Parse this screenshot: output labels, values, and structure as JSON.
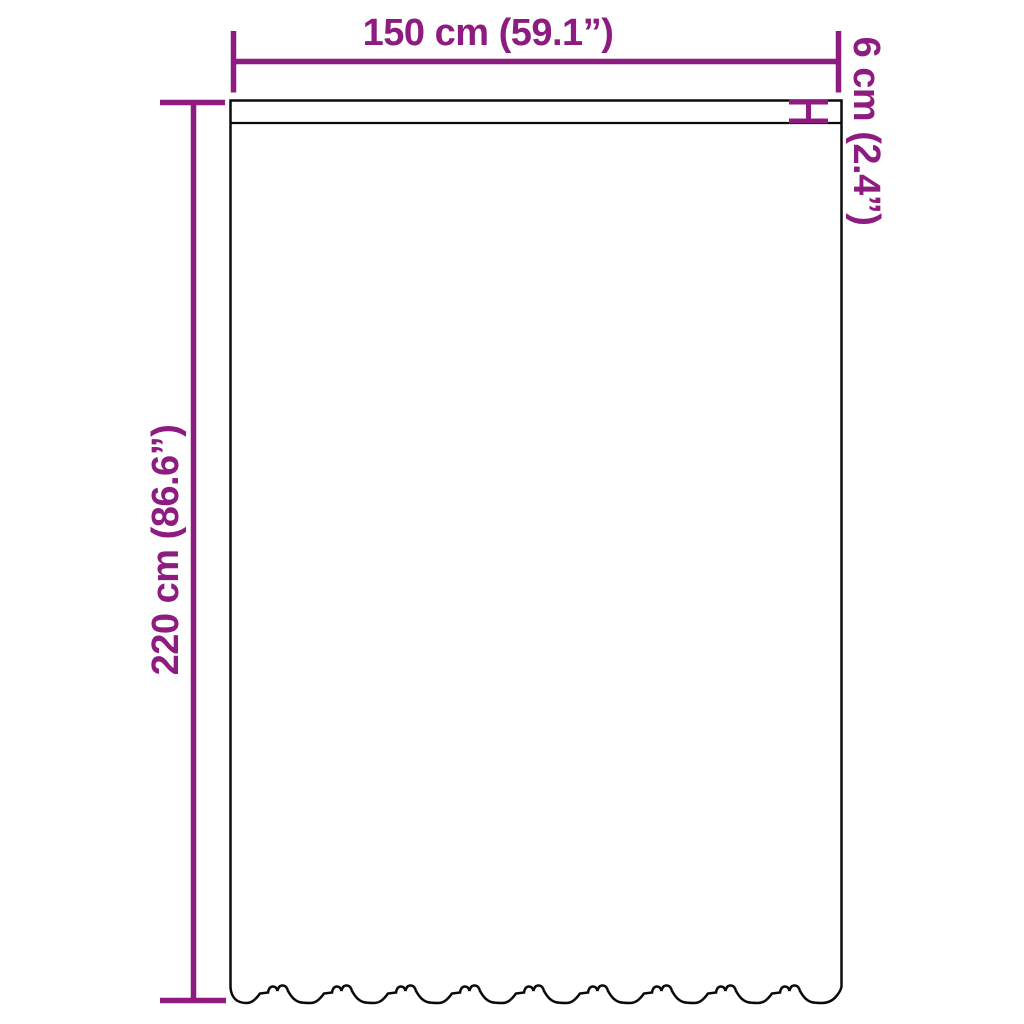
{
  "figure": {
    "kind": "product-dimension-diagram",
    "subject": "curtain-with-scalloped-hem",
    "background_color": "#ffffff",
    "accent_color": "#8E1B80",
    "outline_color": "#0a0a0a"
  },
  "dimensions": {
    "width": {
      "label": "150 cm (59.1”)",
      "cm": 150,
      "inches": 59.1
    },
    "height": {
      "label": "220 cm (86.6”)",
      "cm": 220,
      "inches": 86.6
    },
    "header": {
      "label": "6 cm (2.4”)",
      "cm": 6,
      "inches": 2.4
    }
  }
}
